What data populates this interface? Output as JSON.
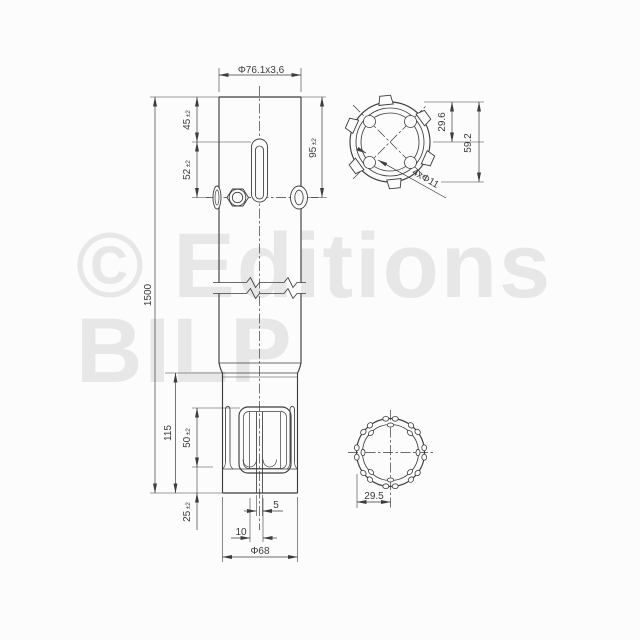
{
  "watermark": {
    "line1": "© Editions",
    "line2": "BILP"
  },
  "front_view": {
    "dim_tube_diameter": "Φ76.1x3,6",
    "dim_slot_offset": {
      "value": "45",
      "tol": "±2"
    },
    "dim_screw_offset": {
      "value": "52",
      "tol": "±2"
    },
    "dim_upper_span": {
      "value": "95",
      "tol": "±2"
    },
    "dim_overall_length": "1500",
    "dim_lower_section": "115",
    "dim_window_height": {
      "value": "50",
      "tol": "±2"
    },
    "dim_bottom_offset": {
      "value": "25",
      "tol": "±2"
    },
    "dim_slit_width": "5",
    "dim_slit_pitch": "10",
    "dim_bottom_diameter": "Φ68"
  },
  "top_section_view": {
    "dim_radius": "29.6",
    "dim_diameter": "59.2",
    "dim_holes": "4xΦ11"
  },
  "bottom_section_view": {
    "dim_radius": "29.5"
  }
}
